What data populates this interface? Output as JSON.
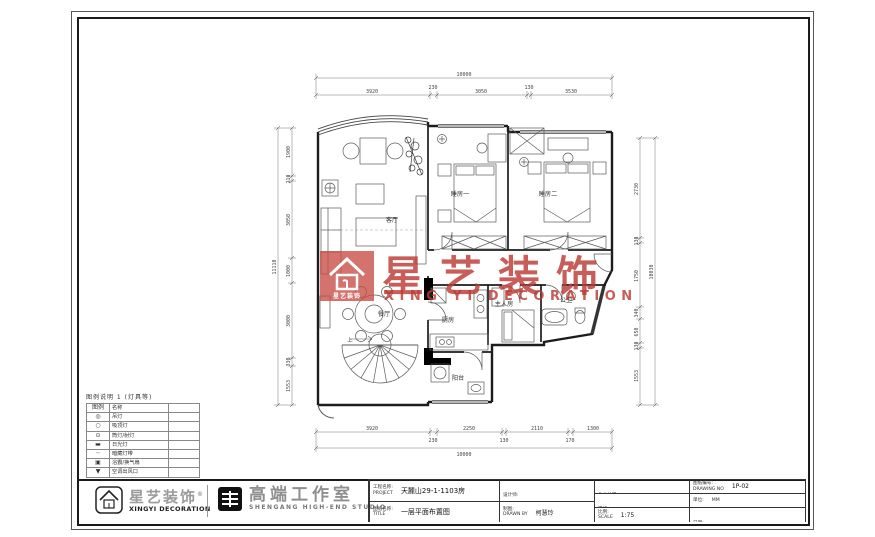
{
  "watermark": {
    "brand_cn": "星艺装饰",
    "brand_en": "XING YI DECORATION",
    "logo_caption": "星艺装饰",
    "accent_color": "#bc3a34"
  },
  "rooms": {
    "living": "客厅",
    "bedroom1": "睡房一",
    "bedroom2": "睡房二",
    "dining": "餐厅",
    "kitchen": "厨房",
    "master": "主人房",
    "bath": "公卫",
    "balcony": "阳台",
    "stair_up": "上"
  },
  "dims": {
    "top": {
      "total": "10000",
      "segments": [
        "3920",
        "230",
        "3050",
        "130",
        "3530"
      ]
    },
    "bottom": {
      "total": "10000",
      "segments": [
        "3920",
        "230",
        "2250",
        "130",
        "2110",
        "170",
        "1300"
      ]
    },
    "left": {
      "total": "11110",
      "segments": [
        "1900",
        "210",
        "3050",
        "1000",
        "3000",
        "330",
        "1553"
      ]
    },
    "right": {
      "total": "10030",
      "segments": [
        "2730",
        "130",
        "1750",
        "340",
        "650",
        "130",
        "1553"
      ]
    }
  },
  "legend": {
    "title": "图例说明 1 (灯具等)",
    "col_symbol": "图例",
    "col_name": "名称",
    "rows": [
      {
        "symbol": "◎",
        "name": "吊灯"
      },
      {
        "symbol": "○",
        "name": "吸顶灯"
      },
      {
        "symbol": "⊙",
        "name": "筒灯/射灯"
      },
      {
        "symbol": "▬",
        "name": "日光灯"
      },
      {
        "symbol": "┄",
        "name": "暗藏灯带"
      },
      {
        "symbol": "▣",
        "name": "浴霸/换气扇"
      },
      {
        "symbol": "▼",
        "name": "空调出风口"
      }
    ]
  },
  "titleblock": {
    "logo1_cn": "星艺装饰",
    "logo1_reg": "®",
    "logo1_en": "XINGYI DECORATION",
    "logo2_cn": "高端工作室",
    "logo2_en": "SHENGANG HIGH-END STUDIO",
    "project_label": "工程名称:\nPROJECT",
    "project_value": "天麓山29-1-1103房",
    "title_label": "图纸名称:\nTITLE",
    "title_value": "一层平面布置图",
    "designer_label": "设计师:\nDESIGNER BY",
    "drawn_label": "制图:\nDRAWN BY",
    "drawn_value": "柯慧玲",
    "client_label": "业主认可:\nCLIENT APPROVED",
    "checked_label": "审核:\nCHECKED",
    "scale_label": "比例:\nSCALE",
    "scale_value": "1:75",
    "drawing_no_label": "图纸编号:\nDRAWING NO",
    "drawing_no_value": "1P-02",
    "unit_label": "单位:",
    "unit_value": "MM",
    "date_label": "日期:\nDATE"
  }
}
